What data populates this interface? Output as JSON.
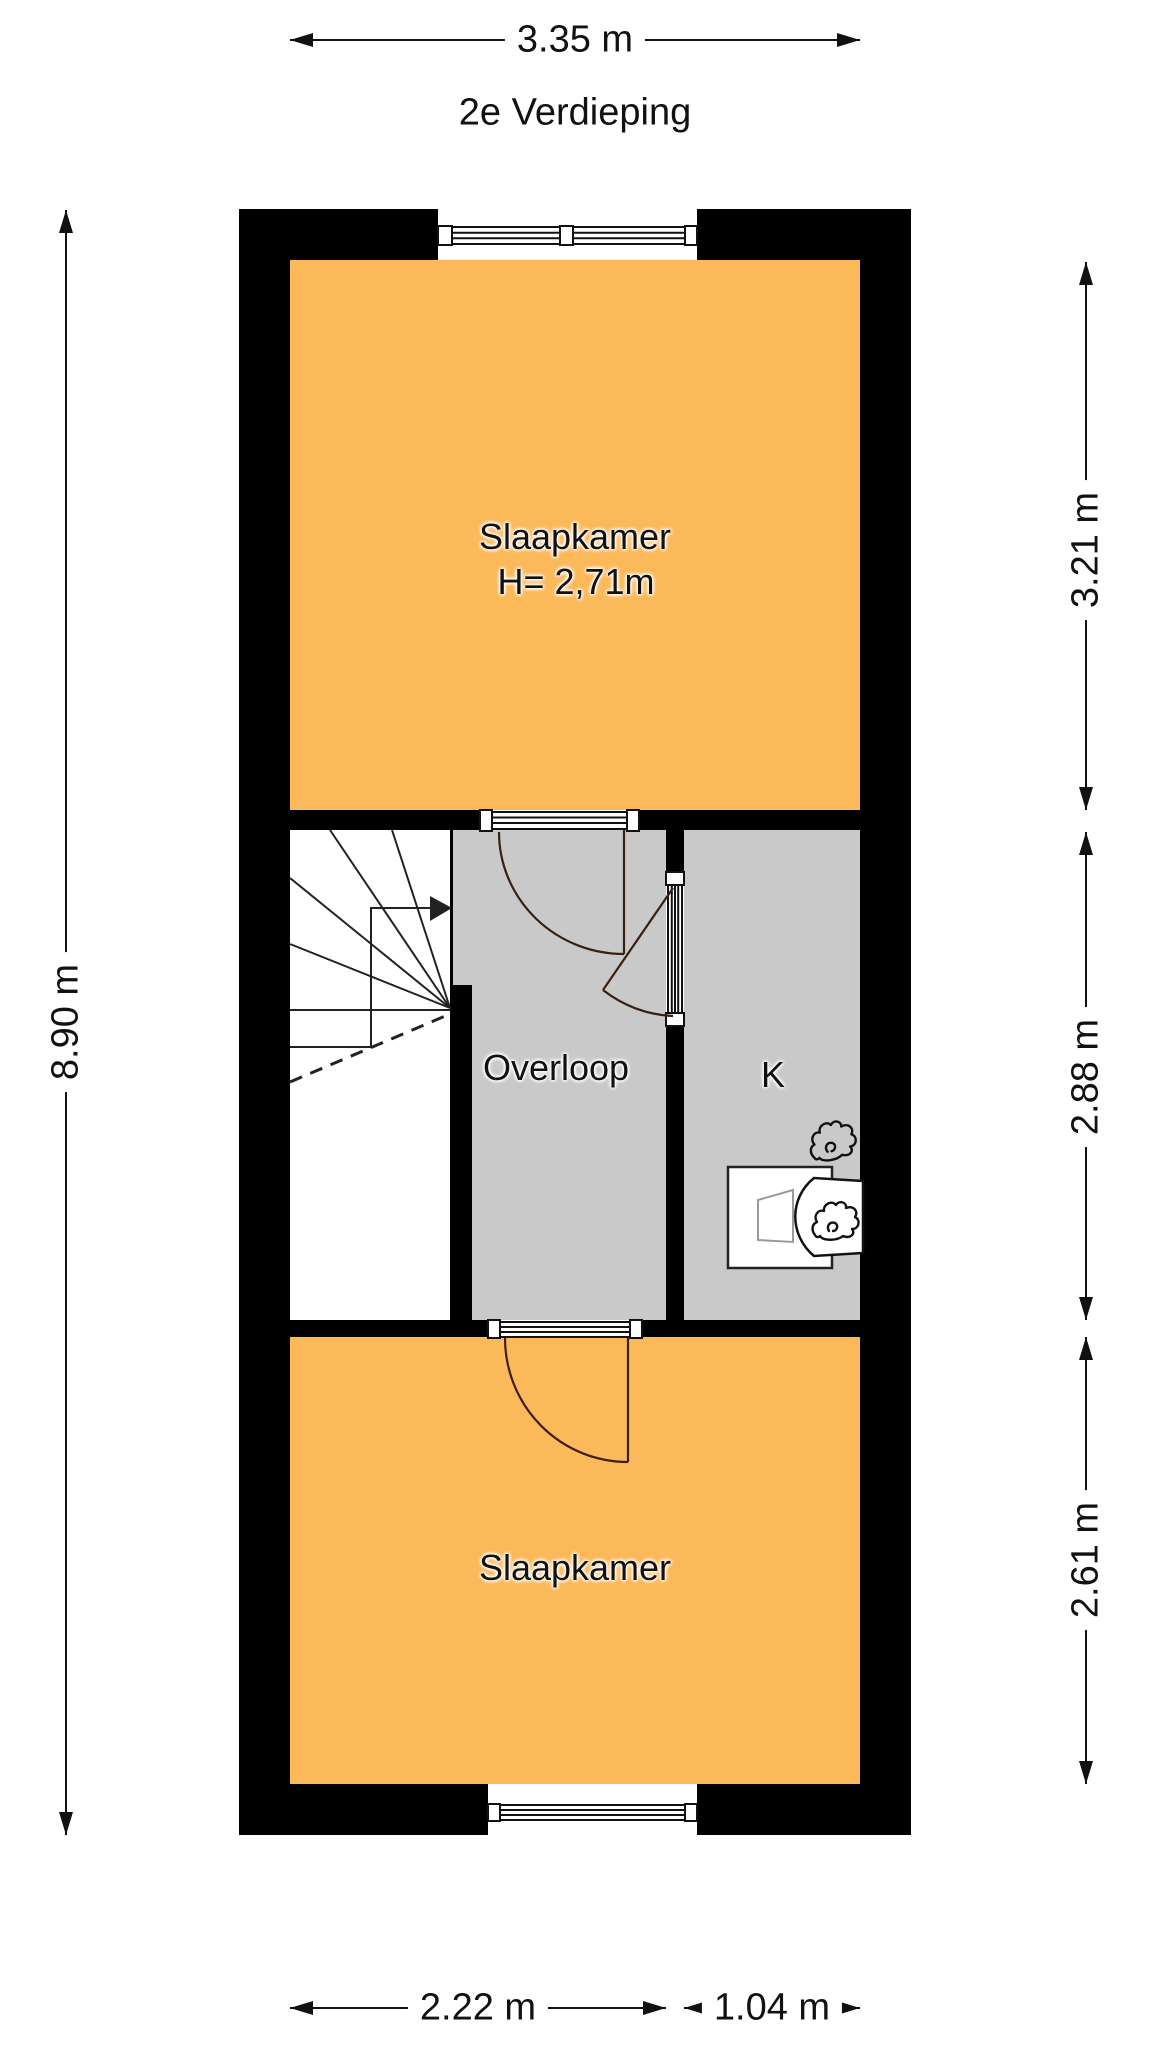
{
  "title": "2e Verdieping",
  "rooms": {
    "bedroom_top": {
      "label": "Slaapkamer",
      "height_label": "H= 2,71m"
    },
    "landing": {
      "label": "Overloop"
    },
    "closet": {
      "label": "K"
    },
    "bedroom_bottom": {
      "label": "Slaapkamer"
    }
  },
  "dimensions": {
    "top": "3.35 m",
    "left": "8.90 m",
    "right_top": "3.21 m",
    "right_middle": "2.88 m",
    "right_bottom": "2.61 m",
    "bottom_left": "2.22 m",
    "bottom_right": "1.04 m"
  },
  "icons": {
    "flame": "flame-icon",
    "stairs_direction": "stairs-up-arrow-icon"
  },
  "colors": {
    "wall": "#000000",
    "room_orange": "#fbb95a",
    "room_gray": "#c9c9c9",
    "line": "#111111",
    "door_arc": "#3a2010"
  }
}
